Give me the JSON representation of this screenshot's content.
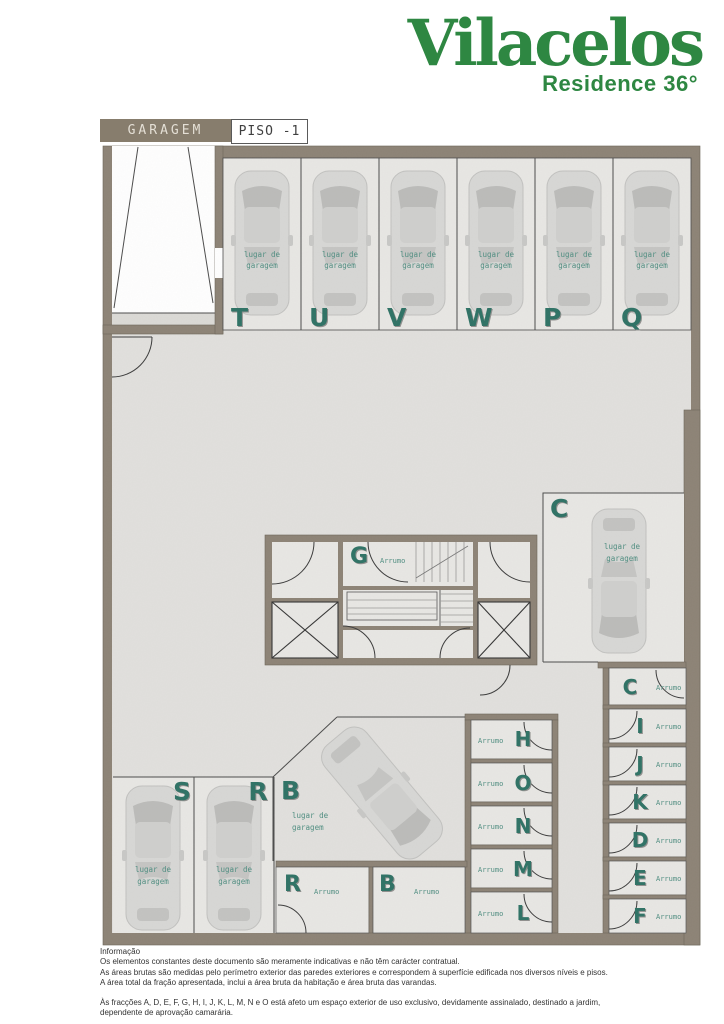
{
  "header": {
    "brand": "Vilacelos",
    "subbrand": "Residence 36°"
  },
  "tags": {
    "area_label": "GARAGEM",
    "floor_label": "PISO -1"
  },
  "plan": {
    "caption_line1": "lugar de",
    "caption_line2": "garagem",
    "storage_caption": "Arrumo",
    "top_stalls": [
      {
        "id": "T"
      },
      {
        "id": "U"
      },
      {
        "id": "V"
      },
      {
        "id": "W"
      },
      {
        "id": "P"
      },
      {
        "id": "Q"
      }
    ],
    "side_stall": {
      "id": "C"
    },
    "core": {
      "room_id": "G"
    },
    "bottom_stalls": [
      {
        "id": "S"
      },
      {
        "id": "R"
      }
    ],
    "angled_stall": {
      "id": "B"
    },
    "right_storage": [
      {
        "id": "C"
      },
      {
        "id": "I"
      },
      {
        "id": "J"
      },
      {
        "id": "K"
      },
      {
        "id": "D"
      },
      {
        "id": "E"
      },
      {
        "id": "F"
      }
    ],
    "mid_storage": [
      {
        "id": "H"
      },
      {
        "id": "O"
      },
      {
        "id": "N"
      },
      {
        "id": "M"
      },
      {
        "id": "L"
      }
    ],
    "bottom_storage": [
      {
        "id": "R"
      },
      {
        "id": "B"
      }
    ]
  },
  "footer": {
    "title": "Informação",
    "lines": [
      "Os elementos constantes deste documento são meramente indicativas e não têm carácter contratual.",
      "As áreas brutas são medidas pelo perímetro exterior das paredes exteriores e correspondem à superfície edificada nos diversos níveis e pisos.",
      "A área total da fração apresentada, inclui a área bruta da habitação e área bruta das varandas."
    ],
    "note_lines": [
      "Às fracções A, D, E, F, G, H, I, J, K, L, M, N e O está afeto um espaço exterior de uso exclusivo, devidamente assinalado, destinado a jardim,",
      "dependente de aprovação camarária."
    ]
  },
  "colors": {
    "brand_green": "#2e8742",
    "letter_teal": "#2d7164",
    "wall": "#8c8275",
    "floor": "#e1e0dd",
    "stall_floor": "#e8e7e4"
  }
}
